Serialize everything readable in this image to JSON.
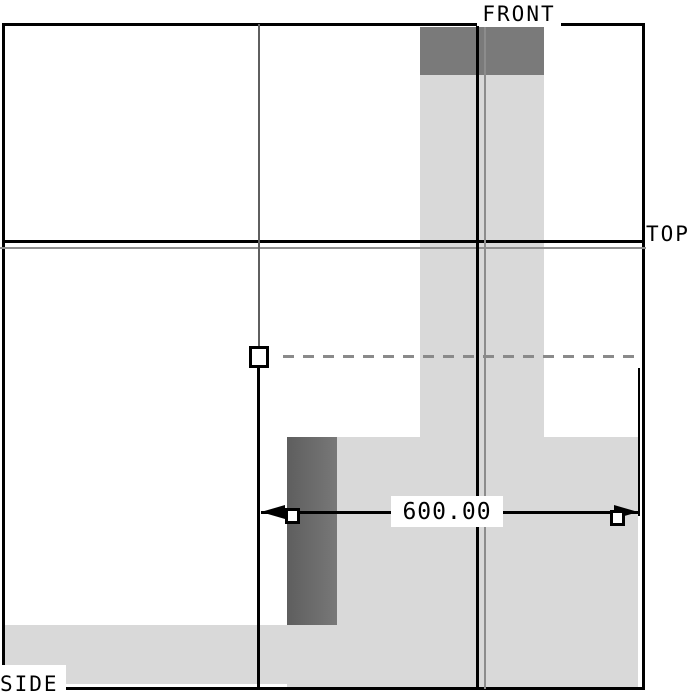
{
  "drawing": {
    "view_labels": {
      "front": "FRONT",
      "top": "TOP",
      "side": "SIDE"
    },
    "dimension": {
      "value": "600.00"
    },
    "colors": {
      "background": "#ffffff",
      "part_fill_light": "#d9d9d9",
      "part_fill_dark_front": "#7a7a7a",
      "part_fill_dark_side": "#686868",
      "line_black": "#000000",
      "line_gray": "#8c8c8c",
      "dashed_reference_gray": "#8a8a8a"
    }
  }
}
